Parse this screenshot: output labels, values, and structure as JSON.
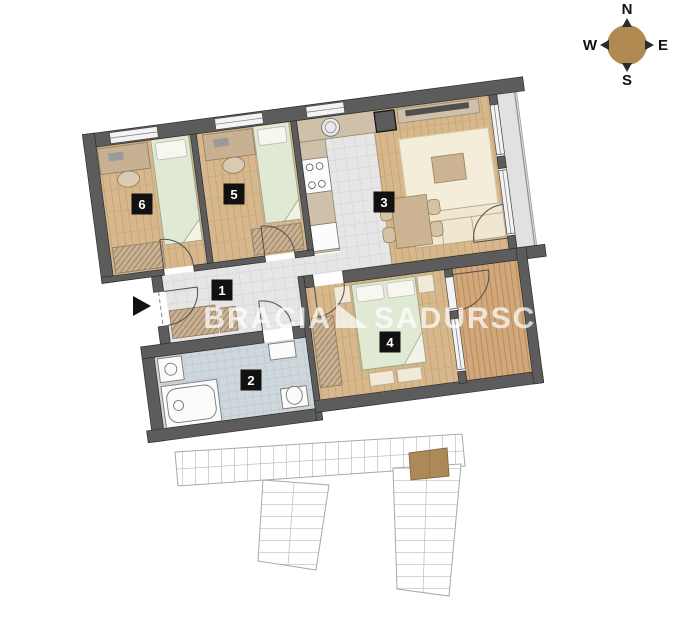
{
  "compass": {
    "north": "N",
    "east": "E",
    "south": "S",
    "west": "W"
  },
  "watermark": {
    "brand_first": "BRACIA",
    "brand_second": "SADURSCY"
  },
  "rooms": [
    {
      "number": "1",
      "type": "hallway"
    },
    {
      "number": "2",
      "type": "bathroom"
    },
    {
      "number": "3",
      "type": "living-room-with-kitchen"
    },
    {
      "number": "4",
      "type": "bedroom"
    },
    {
      "number": "5",
      "type": "bedroom"
    },
    {
      "number": "6",
      "type": "bedroom"
    }
  ],
  "colors": {
    "wall": "#5c5c5c",
    "wood_floor": "#d7b88c",
    "tile_floor": "#e6e6e6",
    "bath_tile": "#cdd7dc",
    "deck": "#d2a87a",
    "bed": "#e0e9d3",
    "furniture_tan": "#ccb392",
    "highlight_unit": "#ac8a57",
    "compass_disc": "#b18a52"
  }
}
